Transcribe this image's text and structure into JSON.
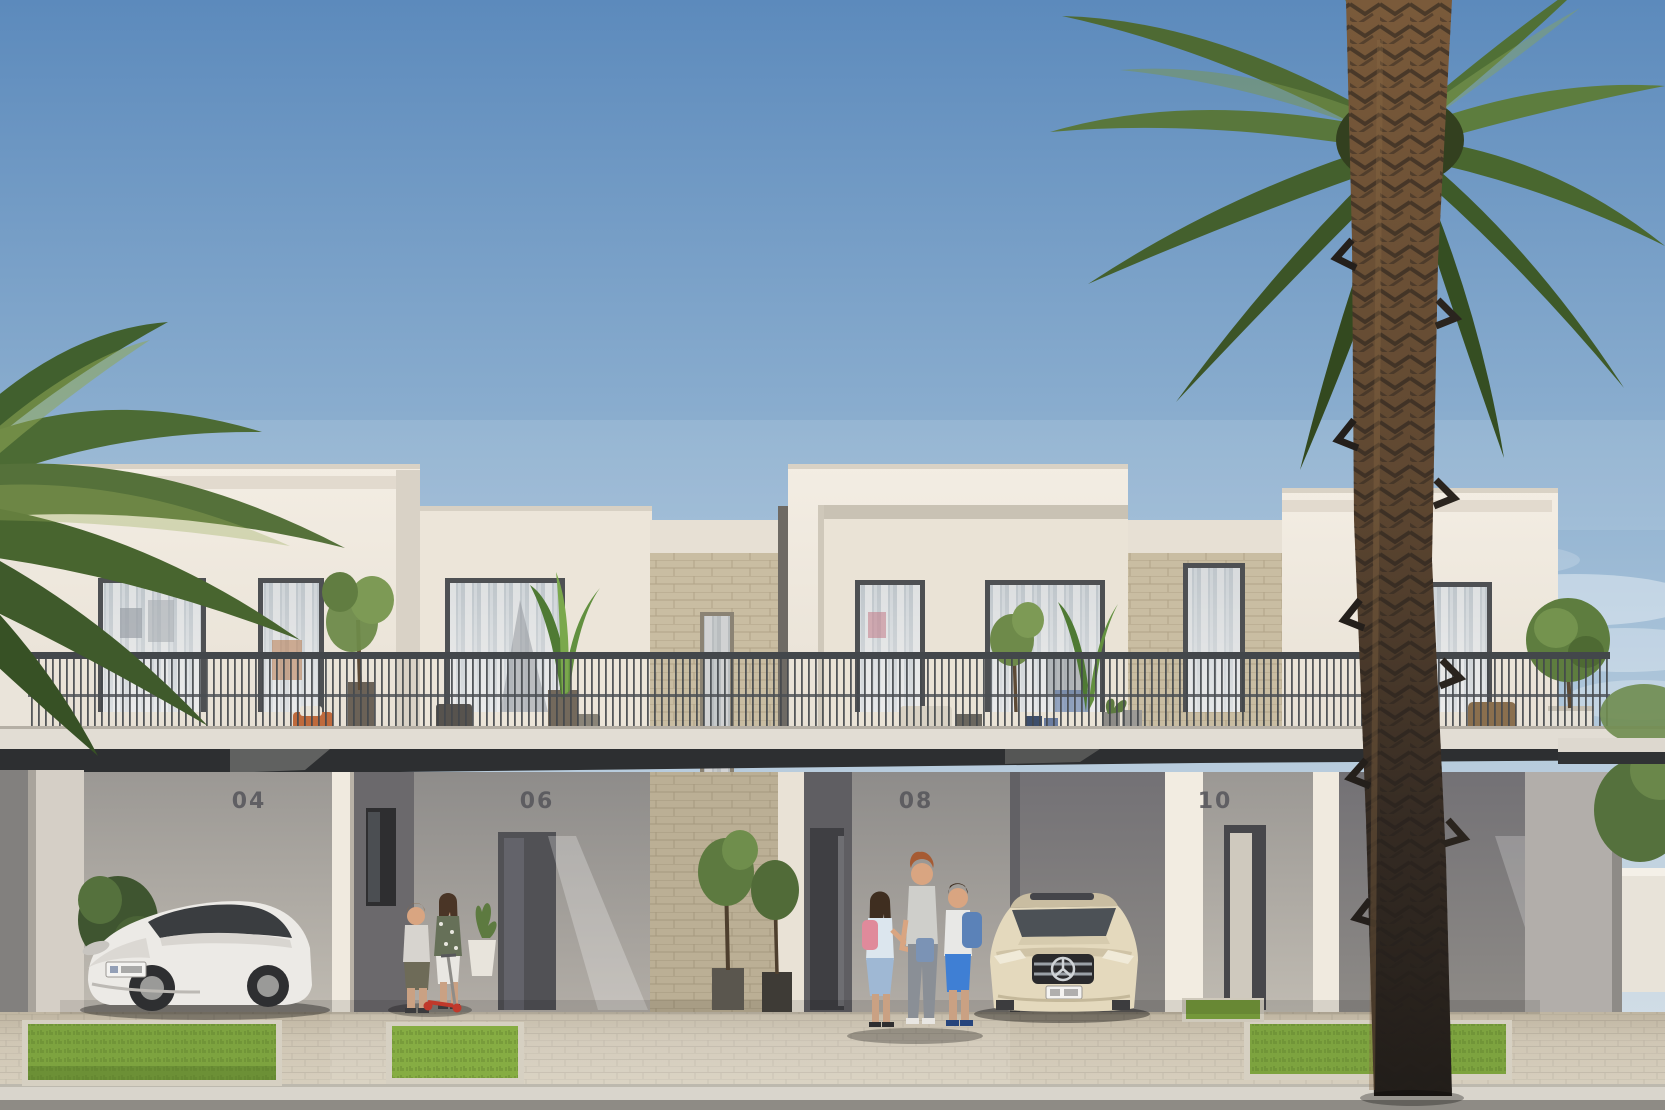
{
  "scene": {
    "type": "architectural exterior rendering",
    "time": "sunny daytime",
    "subject": "row of modern two-storey townhouses with balconies, carports, paved driveway, palm trees"
  },
  "units": [
    {
      "number": "04"
    },
    {
      "number": "06"
    },
    {
      "number": "08"
    },
    {
      "number": "10"
    }
  ],
  "vehicles": [
    {
      "name": "white-sedan",
      "description": "white luxury sedan parked in carport of unit 04"
    },
    {
      "name": "beige-mercedes",
      "description": "beige sedan with three-pointed-star grille parked at unit 08"
    }
  ],
  "people": [
    {
      "name": "boy-with-scooter",
      "description": "boy in grey t-shirt near unit 06 door"
    },
    {
      "name": "girl-with-scooter",
      "description": "girl in floral top with red scooter near unit 06 door"
    },
    {
      "name": "girl-pink-backpack",
      "description": "girl with pink backpack holding mother's hand"
    },
    {
      "name": "mother",
      "description": "woman with auburn hair, grey top and jeans"
    },
    {
      "name": "boy-blue-backpack",
      "description": "boy with blue backpack and bright blue shorts"
    }
  ],
  "vegetation": [
    "palm fronds top-left",
    "tall date palm right",
    "balcony olive trees",
    "banana plants",
    "potted trees at entries",
    "round shrub on right balcony",
    "grass strips"
  ],
  "palette": {
    "sky_top": "#5c8abc",
    "sky_mid": "#93b4d2",
    "sky_horizon": "#d9e2e9",
    "wall_sunlit": "#efe9df",
    "wall_shaded": "#a5a19d",
    "stone_clad": "#c9bda2",
    "canopy_dark": "#2d2f31",
    "railing": "#43474b",
    "window_frame": "#4e5053",
    "grass": "#7da33f",
    "paver": "#cfc6b4",
    "sidewalk": "#d9d5cc",
    "street": "#8e8b85",
    "palm_frond": "#55733a",
    "palm_trunk": "#6e5138",
    "car_white": "#eceae6",
    "car_beige": "#e4d9bd",
    "scooter_red": "#c0392b",
    "backpack_pink": "#e08a9b",
    "backpack_blue": "#5b82b8",
    "shorts_blue": "#3f7fd4"
  }
}
